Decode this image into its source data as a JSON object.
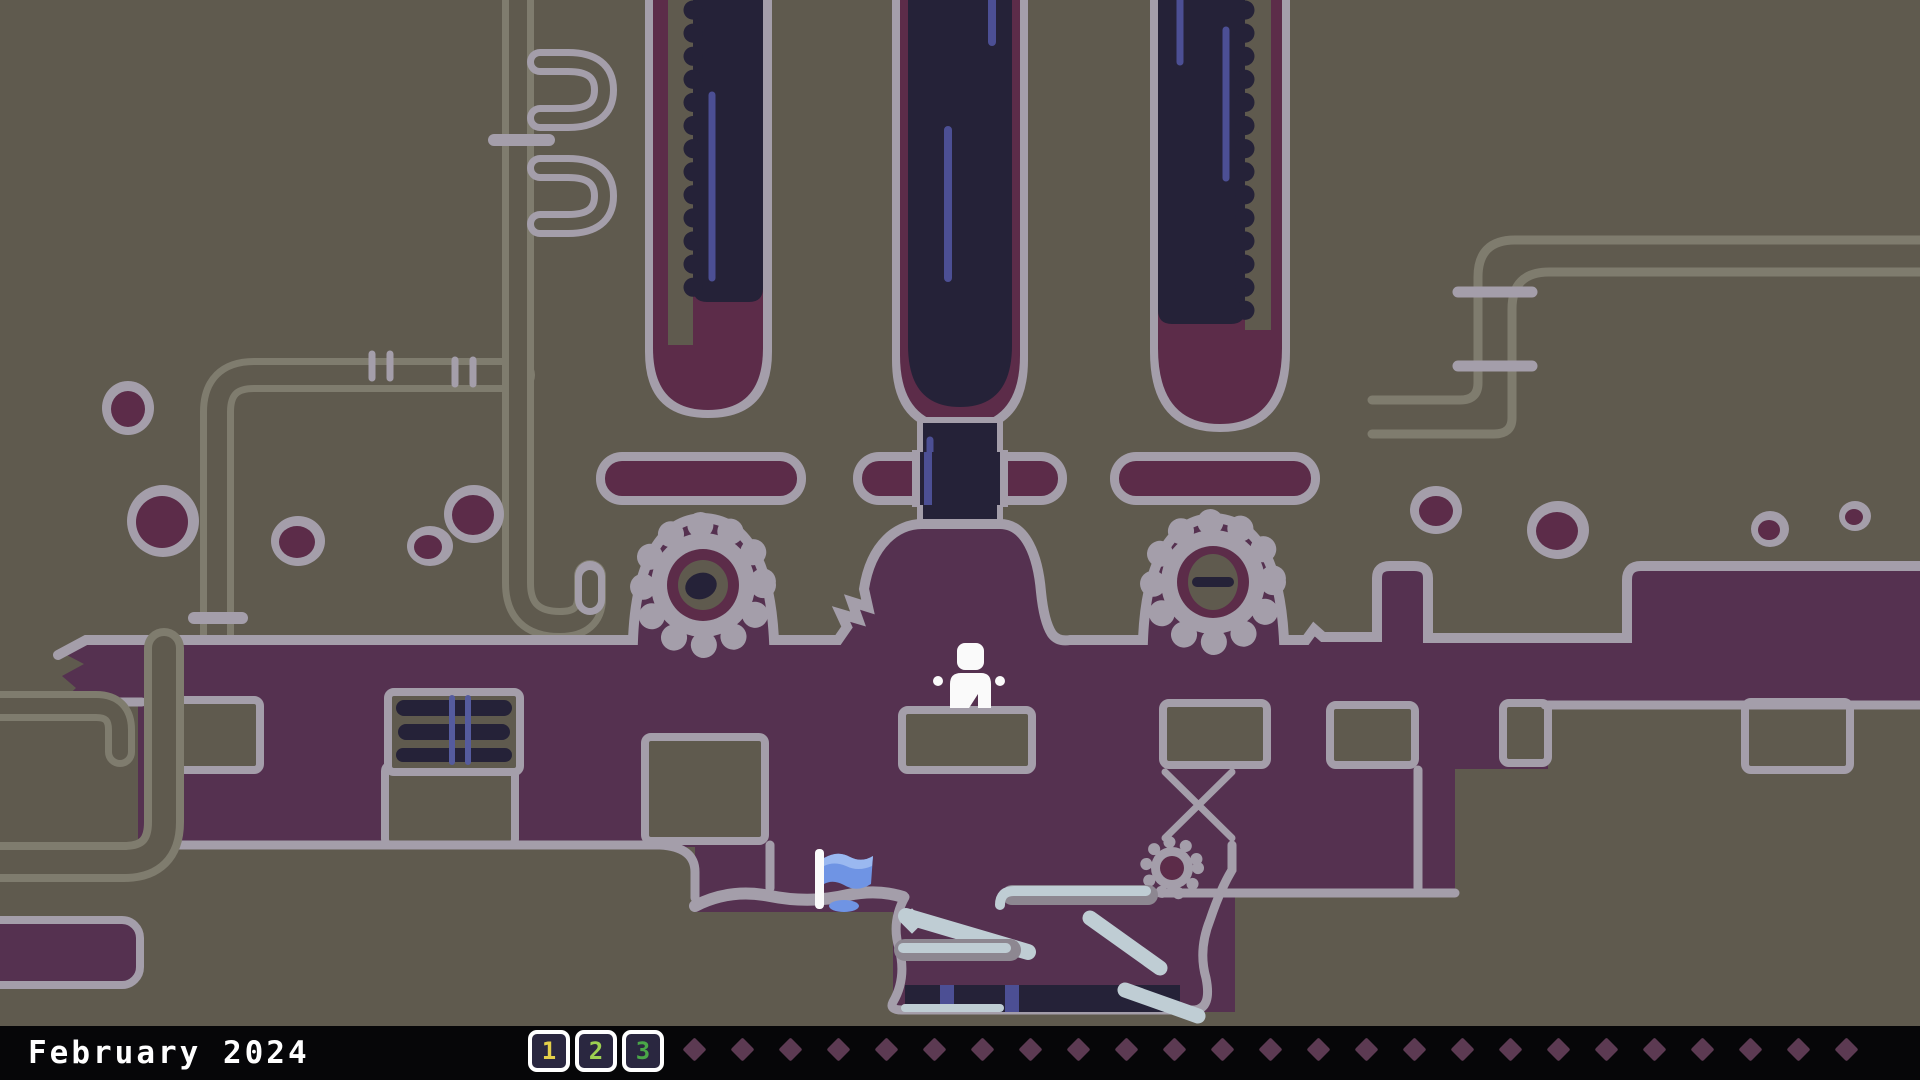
{
  "status_bar": {
    "month_label": "February 2024",
    "completed_days": [
      {
        "label": "1",
        "color": "#e3cf4a"
      },
      {
        "label": "2",
        "color": "#9ccf50"
      },
      {
        "label": "3",
        "color": "#4aa748"
      }
    ],
    "badge_start_x": 528,
    "badge_step": 47,
    "future_day_count": 25,
    "diamond_start_x": 686,
    "diamond_step": 48,
    "colors": {
      "bar_background": "#060608",
      "badge_background": "#2a2740",
      "badge_border": "#ffffff",
      "diamond": "#5c3a52",
      "text": "#ffffff"
    }
  },
  "scene": {
    "entities": {
      "player": "white-pixel-character",
      "flag": "blue-checkpoint-flag",
      "gear_count": 2,
      "pillar_count": 3
    },
    "palette": {
      "background": "#5f5a4e",
      "ground_purple": "#553150",
      "outline_lavender": "#a49eaa",
      "pillar_navy": "#252238",
      "maroon": "#5c2c49",
      "pipe_olive": "#7f7c6e",
      "streak_blue": "#4c4f94",
      "stripe_blue": "#555b9e",
      "ice": "#bfcdd4",
      "floor_gray": "#8d8791",
      "flag_blue": "#6f94e4",
      "flag_blue_light": "#9ab8f0",
      "character_white": "#fafafa"
    }
  }
}
